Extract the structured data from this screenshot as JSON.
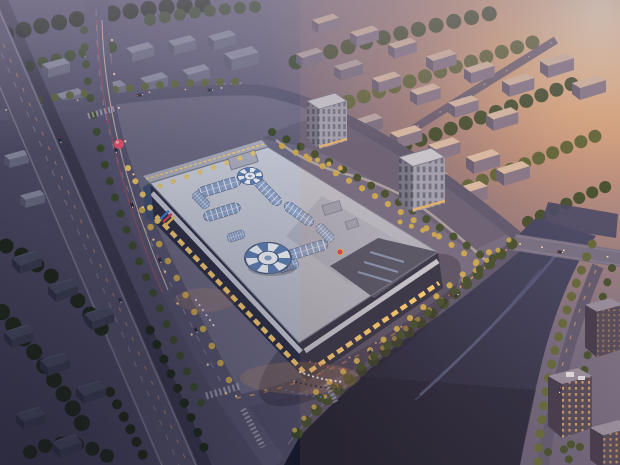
{
  "image": {
    "kind": "architectural-rendering",
    "view": "aerial-dusk",
    "subject": "shopping-mall-complex-with-river-and-residential-district",
    "width": 620,
    "height": 465
  },
  "scene": {
    "landmarks": [
      "elevated-expressway",
      "main-street",
      "parking-lots",
      "low-rise-blocks",
      "shopping-mall",
      "rooftop-skylight-vaults",
      "striped-glass-domes",
      "office-towers",
      "residential-slabs",
      "landscaped-garden-strip",
      "river",
      "road-bridge",
      "riverside-promenade",
      "entrance-plaza-crowd",
      "balloon-sculpture",
      "dark-houses",
      "riverside-buildings"
    ]
  },
  "palette": {
    "base_top": "#8d8499",
    "base_mid": "#5b5874",
    "base_low": "#3e3c56",
    "glow_core": "#ffe9c2",
    "glow_mid": "#f8b97c",
    "glow_far": "#e89a6c",
    "haze": "#9a92a6",
    "river_top": "#3c4266",
    "river_low": "#161a2e",
    "river_hi": "#5d6796",
    "road": "#565470",
    "road_edge": "#7b7992",
    "lane": "#d6d8e6",
    "dash_warm": "#e59a5f",
    "viaduct": "#525069",
    "shadow": "#191827",
    "roof_light": "#ccd0dc",
    "roof_mid": "#a8acbc",
    "roof_dark": "#4d5166",
    "parapet": "#73768c",
    "vault": "#8ba1c7",
    "vault_rib": "#eef2f9",
    "vault_edge": "#5d6b8a",
    "dome_blue": "#5d7fb2",
    "dome_white": "#edf1f7",
    "dome_rim": "#47597c",
    "facade": "#2c2f46",
    "fascia": "#c3c6d3",
    "storefront": "#f8ca70",
    "glow_warm": "#f2a95f",
    "paving": "#6c6983",
    "garden": "#605e76",
    "garden_path": "#b8afad",
    "tree_dark": "#1d2617",
    "tree_mid": "#3a4a2c",
    "tree_olive": "#5a6238",
    "tree_gold": "#c9a84e",
    "tree_gold2": "#e6c468",
    "block_top": "#8b8da3",
    "block_side": "#565870",
    "block_front": "#6b6d85",
    "slab_top": "#b4a5a7",
    "slab_side": "#5f5b73",
    "slab_front": "#716b83",
    "slab_top_lit": "#d6bba6",
    "slab_front_lit": "#80748b",
    "tower_top": "#c5c9d5",
    "tower_left": "#6f7489",
    "tower_right": "#9ca2b4",
    "win": "#3c415a",
    "tower_glow": "#e9b469",
    "warm_win": "#d1a069",
    "br_face": "#484457",
    "br_side": "#37344a",
    "br_top": "#8f8ba0",
    "bridge": "#6d6b85",
    "house_top": "#484b63",
    "house_front": "#3a3c52",
    "house_side": "#2e3046",
    "balloon": "#e4506a",
    "balloon_hi": "#f6aab9",
    "crowd_light": "#eae8ef",
    "crowd_dark": "#262b42",
    "crowd_red": "#c25560",
    "crowd_blue": "#5577b8",
    "lamp": "#ffd9a2",
    "headlight": "#ffe9c8",
    "taillight": "#e05548",
    "banner_blue": "#3f7bd0",
    "banner_red": "#d8434e",
    "banner_gold": "#e8c050"
  }
}
